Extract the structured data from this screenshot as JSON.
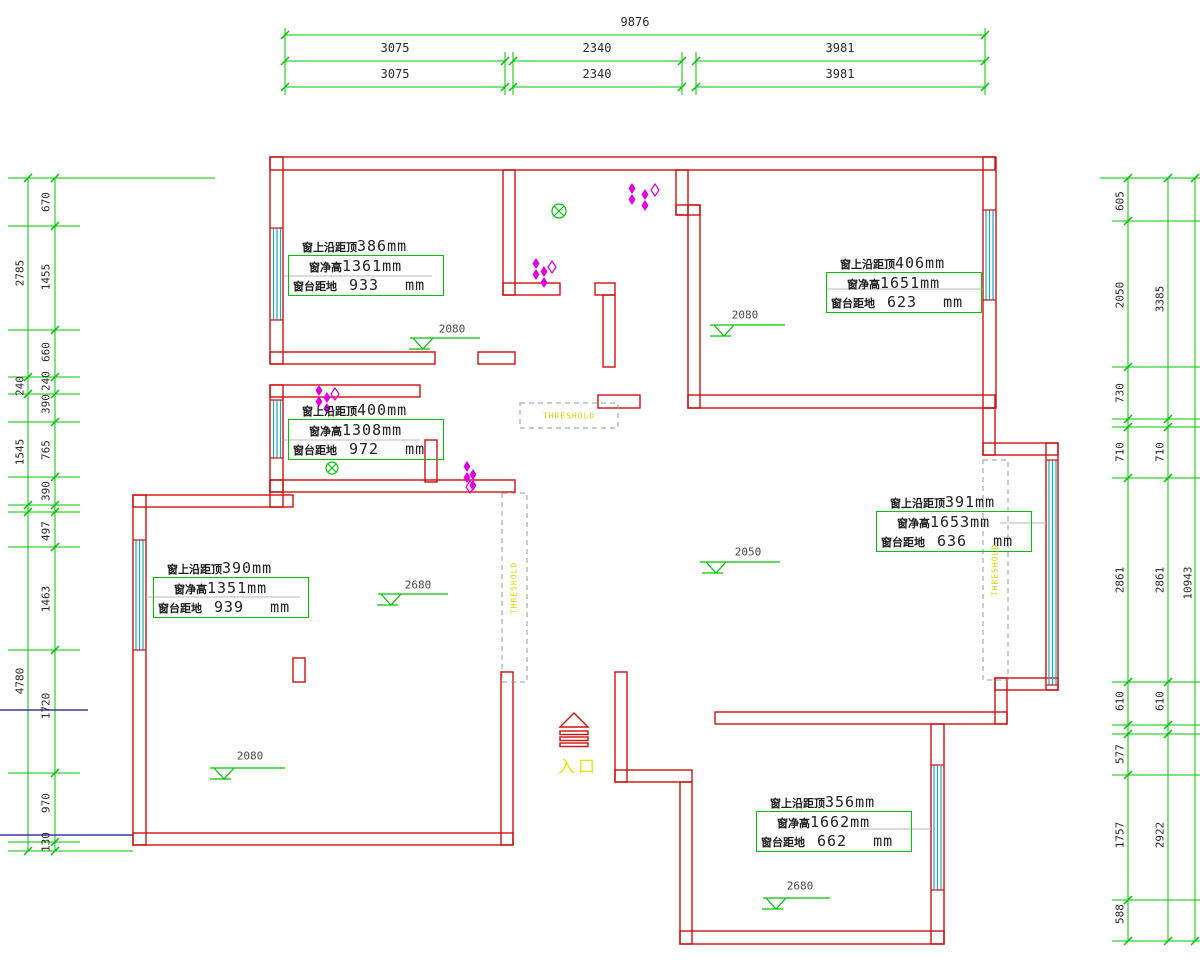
{
  "drawing": {
    "kind": "CAD floor plan with window and ceiling measurements",
    "colors": {
      "wall": "#cf1010",
      "dimension_line": "#00c400",
      "window_symbol": "#1fa8c0",
      "light_symbol": "#e000e0",
      "entry_yellow": "#e6e600",
      "threshold_gray": "#9a9a9a",
      "reference_blue": "#3b3b9e",
      "dim_text": "#2a2a2a"
    }
  },
  "top_dims": {
    "total": "9876",
    "seg1": "3075",
    "seg2": "2340",
    "seg3": "3981"
  },
  "left_dims": {
    "outer": [
      "2785",
      "240",
      "1545",
      "4780"
    ],
    "inner": [
      "670",
      "1455",
      "660",
      "240",
      "390",
      "765",
      "390",
      "497",
      "1463",
      "1720",
      "970",
      "130"
    ]
  },
  "right_dims": {
    "inner": [
      "605",
      "2050",
      "730",
      "710",
      "2861",
      "610",
      "577",
      "1757",
      "588"
    ],
    "middle": [
      "3385",
      "710",
      "2861",
      "610",
      "2922"
    ],
    "outer": "10943"
  },
  "window_annotations": [
    {
      "line1_label": "窗上沿距顶",
      "line1_value": "386mm",
      "line2_label": "窗净高",
      "line2_value": "1361mm",
      "line3_label": "窗台距地",
      "line3_value": "933",
      "line3_unit": "mm"
    },
    {
      "line1_label": "窗上沿距顶",
      "line1_value": "406mm",
      "line2_label": "窗净高",
      "line2_value": "1651mm",
      "line3_label": "窗台距地",
      "line3_value": "623",
      "line3_unit": "mm"
    },
    {
      "line1_label": "窗上沿距顶",
      "line1_value": "400mm",
      "line2_label": "窗净高",
      "line2_value": "1308mm",
      "line3_label": "窗台距地",
      "line3_value": "972",
      "line3_unit": "mm"
    },
    {
      "line1_label": "窗上沿距顶",
      "line1_value": "390mm",
      "line2_label": "窗净高",
      "line2_value": "1351mm",
      "line3_label": "窗台距地",
      "line3_value": "939",
      "line3_unit": "mm"
    },
    {
      "line1_label": "窗上沿距顶",
      "line1_value": "391mm",
      "line2_label": "窗净高",
      "line2_value": "1653mm",
      "line3_label": "窗台距地",
      "line3_value": "636",
      "line3_unit": "mm"
    },
    {
      "line1_label": "窗上沿距顶",
      "line1_value": "356mm",
      "line2_label": "窗净高",
      "line2_value": "1662mm",
      "line3_label": "窗台距地",
      "line3_unit": "mm",
      "line3_value": "662"
    }
  ],
  "elevation_markers": [
    "2080",
    "2080",
    "2680",
    "2050",
    "2080",
    "2680"
  ],
  "thresholds": {
    "label": "THRESHOLD"
  },
  "entry": {
    "label": "入口"
  }
}
